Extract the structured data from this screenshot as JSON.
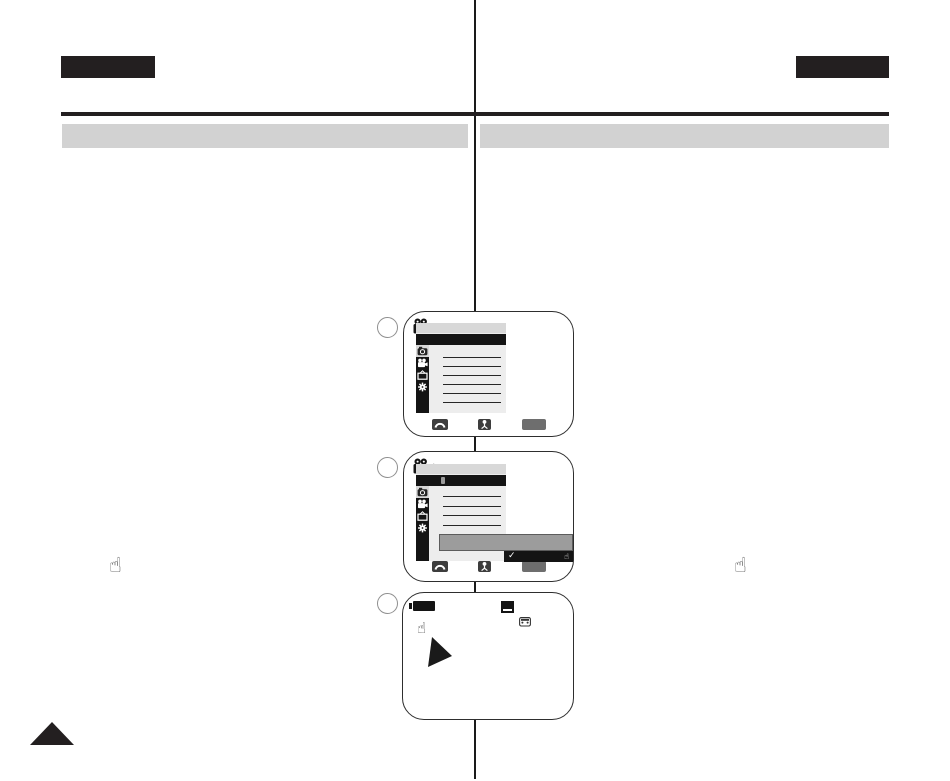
{
  "page": {
    "bg": "#ffffff",
    "divider_color": "#1a1a1a",
    "ink": "#231f20"
  },
  "header": {
    "left_tab_color": "#231f20",
    "right_tab_color": "#231f20",
    "rule_color": "#231f20"
  },
  "section_bars": {
    "left_color": "#d2d2d2",
    "right_color": "#d2d2d2"
  },
  "margin": {
    "left_hand_glyph": "☝",
    "right_hand_glyph": "☝",
    "page_corner_shape": "triangle-up"
  },
  "steps": [
    {
      "circle_label": ""
    },
    {
      "circle_label": ""
    },
    {
      "circle_label": ""
    }
  ],
  "camcorder_screen": {
    "menu": {
      "header_color": "#d8d8d8",
      "selected_row_color": "#141414",
      "sidebar_color": "#141414",
      "content_color": "#ededed",
      "active_tab_color": "#d8d8d8",
      "sidebar_icons": [
        "camera-tab-icon",
        "camcorder-tab-icon",
        "tv-tab-icon",
        "gear-tab-icon"
      ],
      "screen1_line_count": 6,
      "screen2_line_count": 4
    },
    "footer": {
      "dial_icon": "jog-dial-arc",
      "joystick_icon": "joystick",
      "menu_button_color": "#6e6e6e"
    },
    "selection_popup": {
      "bar_color": "#9c9c9c",
      "confirm_bar_color": "#141414",
      "checkmark_glyph": "✓",
      "hand_glyph": "☝"
    },
    "osd": {
      "battery_icon": "battery-indicator",
      "tape_icon": "tape-indicator",
      "cassette_icon": "cassette-indicator",
      "hand_glyph": "☝",
      "pointer_shape": "triangle-pointer"
    }
  }
}
